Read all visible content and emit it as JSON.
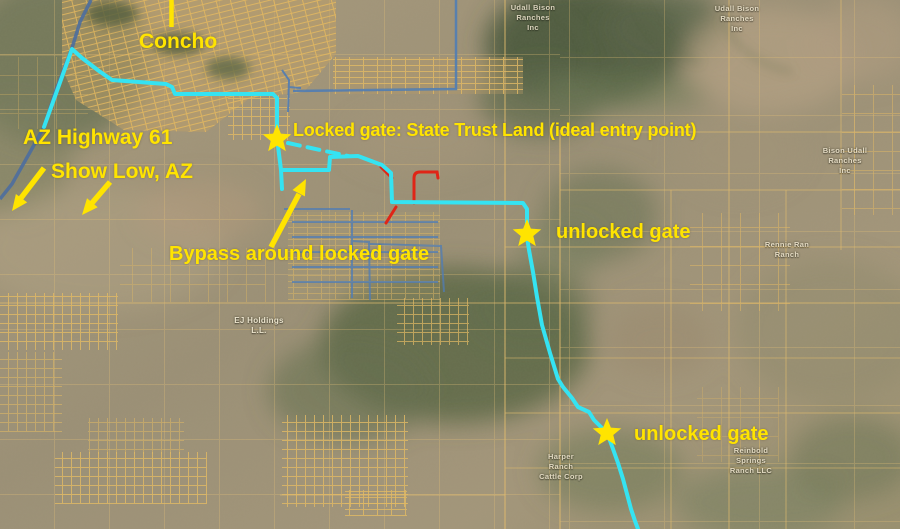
{
  "map": {
    "annotations": {
      "concho": "Concho",
      "az_highway_61": "AZ Highway 61",
      "show_low": "Show Low, AZ",
      "locked_gate": "Locked gate: State Trust Land (ideal entry point)",
      "bypass": "Bypass around locked gate",
      "unlocked_gate_1": "unlocked gate",
      "unlocked_gate_2": "unlocked gate"
    },
    "owner_labels": [
      {
        "lines": [
          "Udall Bison",
          "Ranches",
          "Inc"
        ]
      },
      {
        "lines": [
          "Udall Bison",
          "Ranches",
          "Inc"
        ]
      },
      {
        "lines": [
          "Bison Udall",
          "Ranches",
          "Inc"
        ]
      },
      {
        "lines": [
          "Rennie Ran",
          "Ranch"
        ]
      },
      {
        "lines": [
          "Harper",
          "Ranch",
          "Cattle Corp"
        ]
      },
      {
        "lines": [
          "Reinbold",
          "Springs",
          "Ranch LLC"
        ]
      },
      {
        "lines": [
          "EJ Holdings",
          "L.L."
        ]
      }
    ],
    "markers": [
      {
        "name": "locked-gate-star"
      },
      {
        "name": "unlocked-gate-star-1"
      },
      {
        "name": "unlocked-gate-star-2"
      }
    ],
    "colors": {
      "annotation_yellow": "#ffe400",
      "route_cyan": "#35e3f2",
      "road_blue": "#507db4",
      "highlight_red": "#e02517",
      "parcel_tan": "#e2bc6d"
    }
  }
}
